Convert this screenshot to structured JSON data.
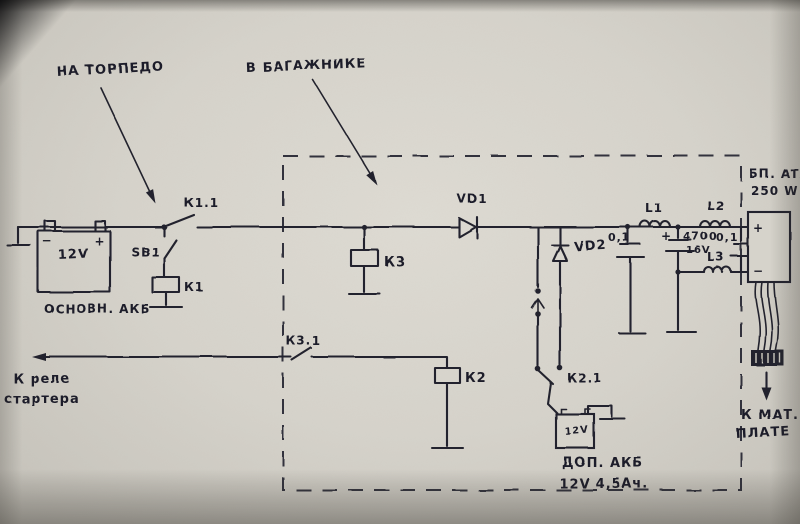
{
  "colors": {
    "paper": "#d6d3cb",
    "ink": "#24242d"
  },
  "annotations": {
    "dash_location": "НА ТОРПЕДО",
    "trunk_location": "В БАГАЖНИКЕ",
    "starter_line1": "К реле",
    "starter_line2": "стартера",
    "motherboard_line1": "К МАТ.",
    "motherboard_line2": "ПЛАТЕ"
  },
  "main_battery": {
    "voltage": "12V",
    "minus": "−",
    "plus": "+",
    "label": "ОСНОВН. АКБ"
  },
  "aux_battery": {
    "voltage": "12V",
    "label": "ДОП. АКБ",
    "rating": "12V 4,5Ач."
  },
  "psu": {
    "name": "БП. ATX",
    "power": "250 W",
    "plus": "+",
    "minus": "−"
  },
  "refs": {
    "sb1": "SB1",
    "k1": "К1",
    "k1_1": "К1.1",
    "k2": "К2",
    "k2_1": "К2.1",
    "k3": "К3",
    "k3_1": "К3.1",
    "vd1": "VD1",
    "vd2": "VD2",
    "l1": "L1",
    "l2": "L2",
    "l3": "L3"
  },
  "caps": {
    "input": "0,1",
    "bulk_value": "4700",
    "bulk_voltage": "16V",
    "bulk_plus": "+",
    "output": "0,1"
  }
}
